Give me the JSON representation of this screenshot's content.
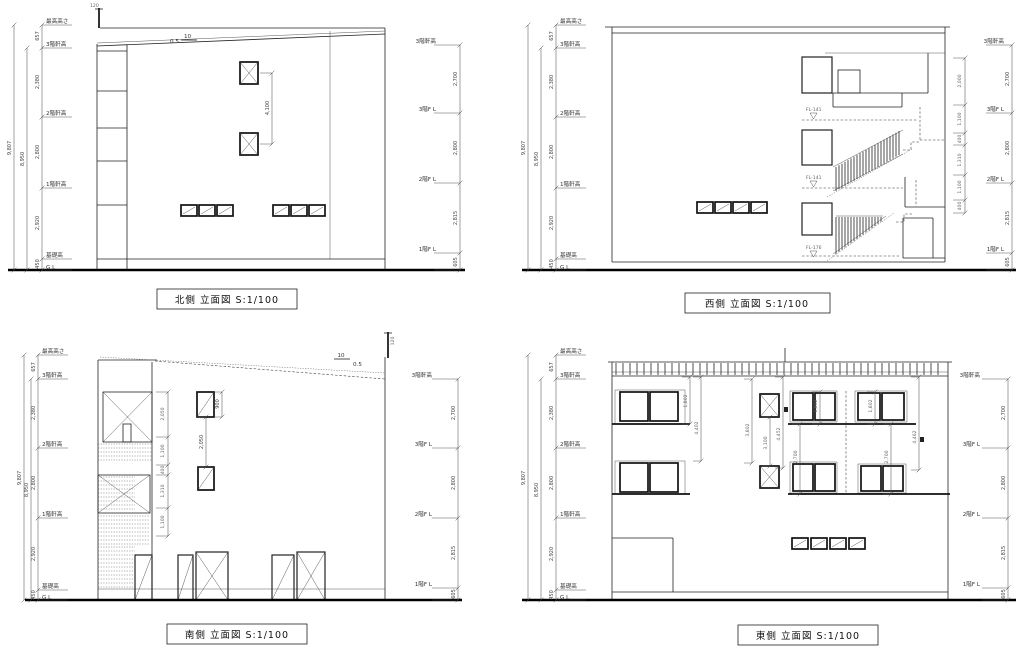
{
  "colors": {
    "background": "#ffffff",
    "line": "#222222"
  },
  "common": {
    "levels_left": [
      "最高高さ",
      "3階軒高",
      "2階軒高",
      "1階軒高",
      "基礎高",
      "G L"
    ],
    "dims_left": [
      "657",
      "2,380",
      "2,800",
      "2,920",
      "450"
    ],
    "totals_left": [
      "9,807",
      "8,950"
    ],
    "levels_right": [
      "3階軒高",
      "3階F L",
      "2階F L",
      "1階F L"
    ],
    "dims_right": [
      "2,700",
      "2,800",
      "2,815",
      "605"
    ]
  },
  "north": {
    "title": "北側 立面図 S:1/100",
    "dim_window": "4,100",
    "slope_run": "10",
    "slope_rise": "0.5",
    "antenna_height": "120"
  },
  "west": {
    "title": "西側 立面図 S:1/100",
    "fl_markers": [
      "FL-141",
      "FL-141",
      "FL-176"
    ],
    "dims_openings": [
      "2,000",
      "1,100",
      "400",
      "1,310",
      "1,100",
      "400"
    ]
  },
  "south": {
    "title": "南側 立面図 S:1/100",
    "dims_stair": [
      "2,050",
      "1,100",
      "400",
      "1,310",
      "1,100"
    ],
    "dim_window_height": "900",
    "dim_window_gap": "2,050",
    "slope_run": "10",
    "slope_rise": "0.5",
    "antenna_height": "120"
  },
  "east": {
    "title": "東側 立面図 S:1/100",
    "dims": {
      "window_3f_left": "1,802",
      "total_left": "4,402",
      "mid_left": "3,802",
      "mid_center": "3,100",
      "mid_right": "4,452",
      "window_3f_a": "1,802",
      "window_3f_b": "1,802",
      "window_2f_a": "2,700",
      "window_2f_b": "2,700",
      "total_right": "4,462"
    }
  }
}
